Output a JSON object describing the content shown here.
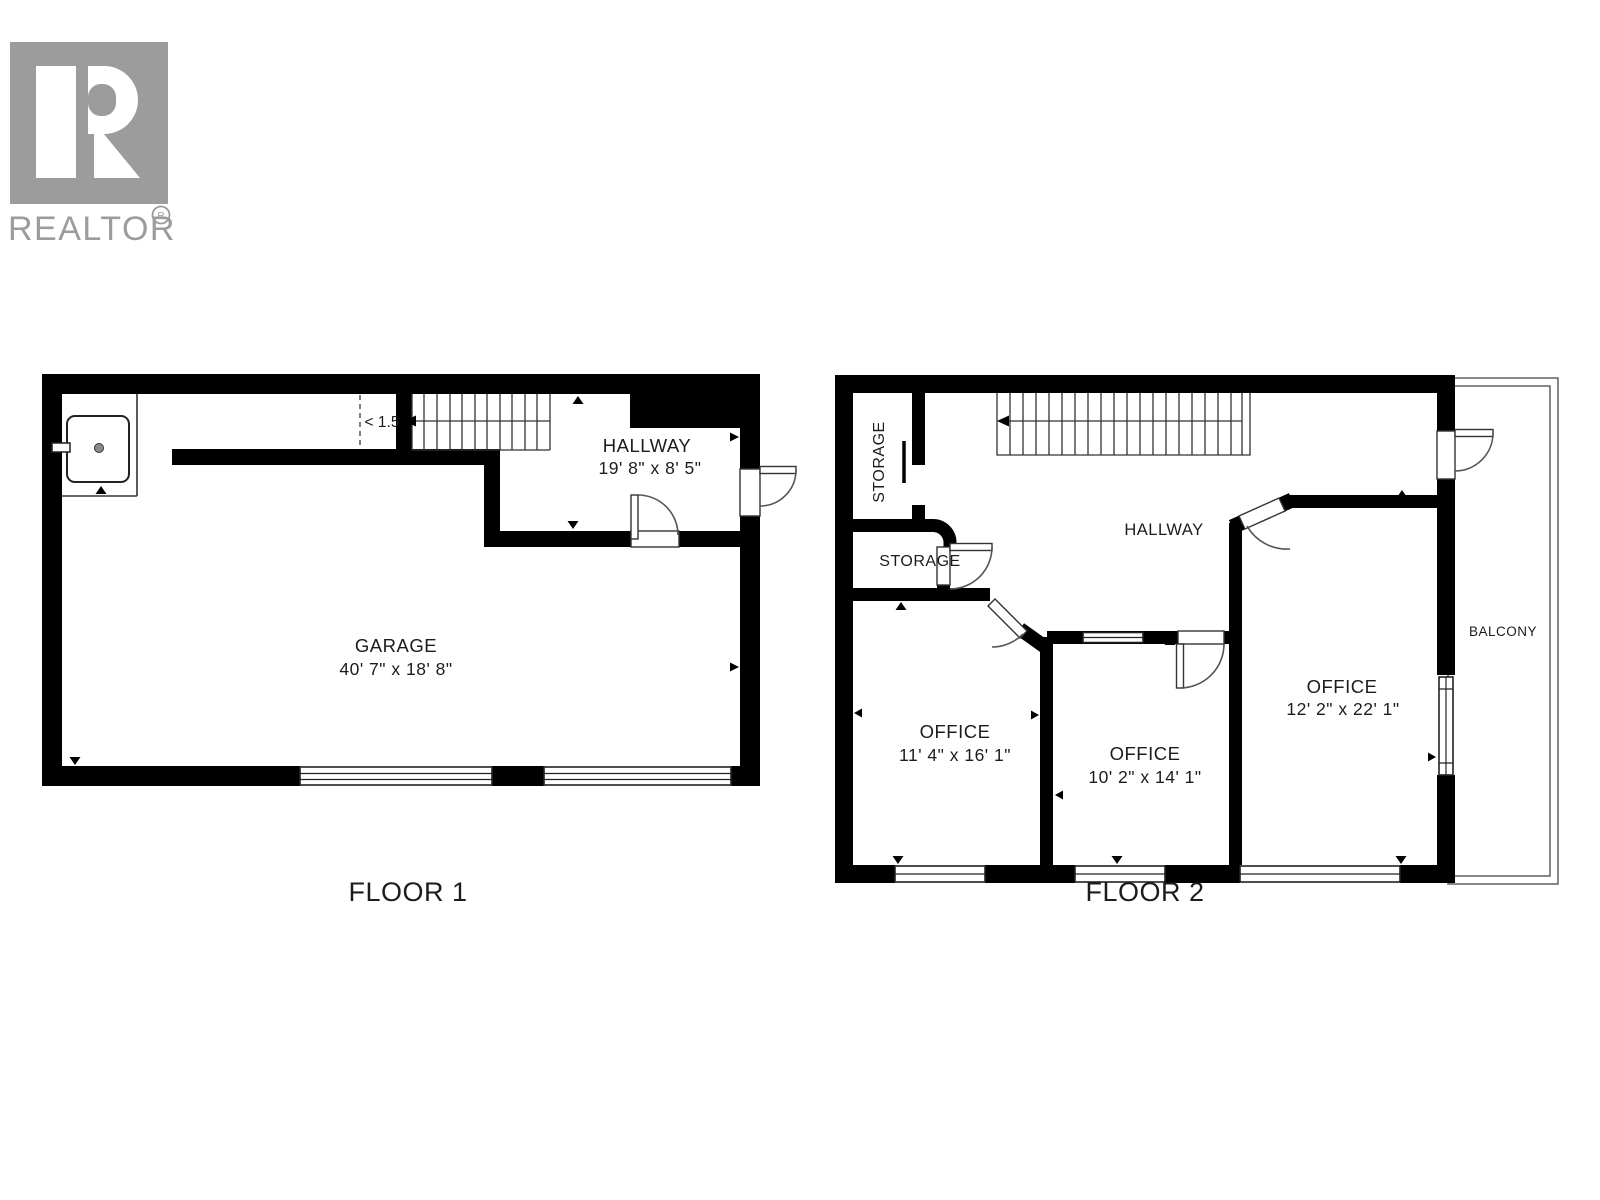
{
  "branding": {
    "logo_text": "REALTOR",
    "registered_mark": "R",
    "logo_color": "#9c9c9c"
  },
  "colors": {
    "walls": "#000000",
    "background": "#ffffff"
  },
  "floor1": {
    "label": "FLOOR 1",
    "low_headroom_annotation": "< 1.5",
    "rooms": {
      "garage": {
        "name": "GARAGE",
        "dimensions": "40' 7\" x 18' 8\""
      },
      "hallway": {
        "name": "HALLWAY",
        "dimensions": "19' 8\" x 8' 5\""
      }
    }
  },
  "floor2": {
    "label": "FLOOR 2",
    "rooms": {
      "storage_closet": {
        "name": "STORAGE"
      },
      "storage": {
        "name": "STORAGE"
      },
      "hallway": {
        "name": "HALLWAY"
      },
      "office_left": {
        "name": "OFFICE",
        "dimensions": "11' 4\" x 16' 1\""
      },
      "office_middle": {
        "name": "OFFICE",
        "dimensions": "10' 2\" x 14' 1\""
      },
      "office_right": {
        "name": "OFFICE",
        "dimensions": "12' 2\" x 22' 1\""
      },
      "balcony": {
        "name": "BALCONY"
      }
    }
  }
}
